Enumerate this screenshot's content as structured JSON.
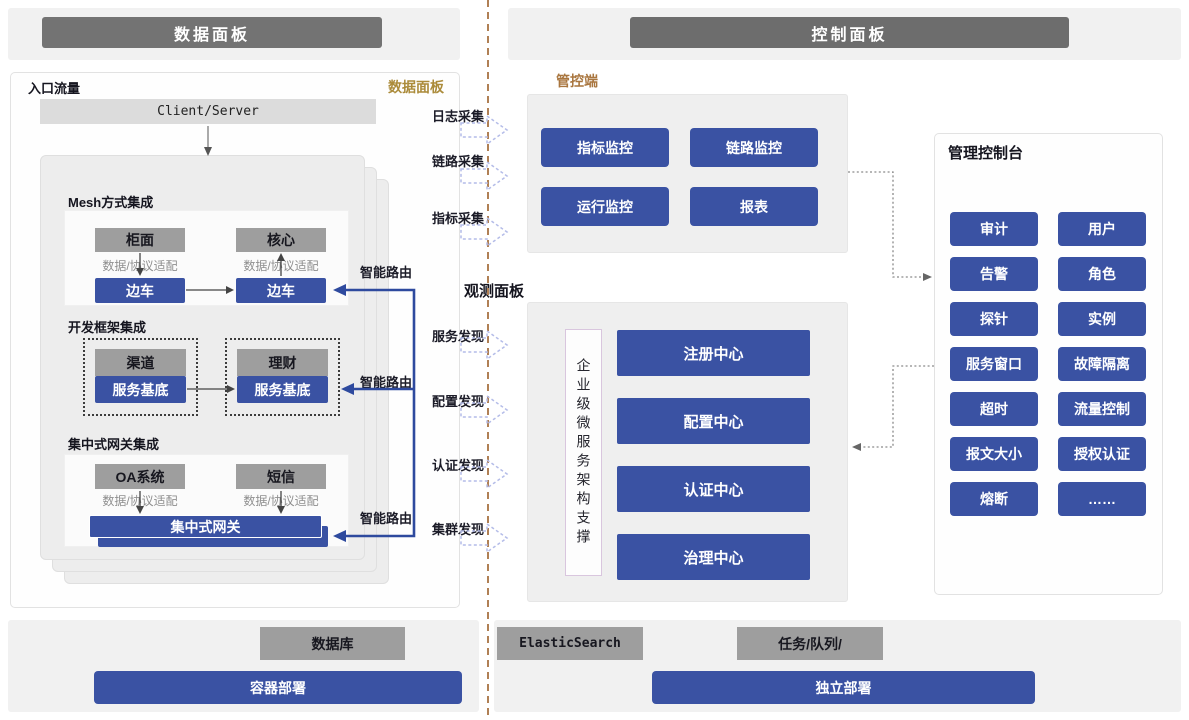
{
  "colors": {
    "accent_blue": "#3a52a3",
    "box_gray": "#9e9e9e",
    "header_gray": "#737373",
    "gold_tag": "#ab8b3a",
    "brown_tag": "#a9763f",
    "divider_brown": "#b08055"
  },
  "headers": {
    "left": "数据面板",
    "right": "控制面板"
  },
  "data_plane": {
    "entry_label": "入口流量",
    "corner_tag": "数据面板",
    "client_server": "Client/Server",
    "smart_route_labels": [
      "智能路由",
      "智能路由",
      "智能路由"
    ],
    "mesh": {
      "title": "Mesh方式集成",
      "left_top": "柜面",
      "right_top": "核心",
      "left_adapter": "数据/协议适配",
      "right_adapter": "数据/协议适配",
      "left_bottom": "边车",
      "right_bottom": "边车"
    },
    "framework": {
      "title": "开发框架集成",
      "left_top": "渠道",
      "left_bottom": "服务基底",
      "right_top": "理财",
      "right_bottom": "服务基底"
    },
    "gateway": {
      "title": "集中式网关集成",
      "left_top": "OA系统",
      "right_top": "短信",
      "left_adapter": "数据/协议适配",
      "right_adapter": "数据/协议适配",
      "bar": "集中式网关"
    }
  },
  "flows": {
    "collect": [
      "日志采集",
      "链路采集",
      "指标采集"
    ],
    "observe_title": "观测面板",
    "discover": [
      "服务发现",
      "配置发现",
      "认证发现",
      "集群发现"
    ]
  },
  "control_plane": {
    "monitor": {
      "tag": "管控端",
      "buttons": [
        "指标监控",
        "链路监控",
        "运行监控",
        "报表"
      ]
    },
    "microservice": {
      "side_label": "企业级微服务架构支撑",
      "centers": [
        "注册中心",
        "配置中心",
        "认证中心",
        "治理中心"
      ]
    },
    "console": {
      "title": "管理控制台",
      "buttons": [
        "审计",
        "用户",
        "告警",
        "角色",
        "探针",
        "实例",
        "服务窗口",
        "故障隔离",
        "超时",
        "流量控制",
        "报文大小",
        "授权认证",
        "熔断",
        "……"
      ]
    }
  },
  "infra": {
    "database": "数据库",
    "container_deploy": "容器部署",
    "elastic": "ElasticSearch",
    "queue": "任务/队列/",
    "standalone_deploy": "独立部署"
  }
}
